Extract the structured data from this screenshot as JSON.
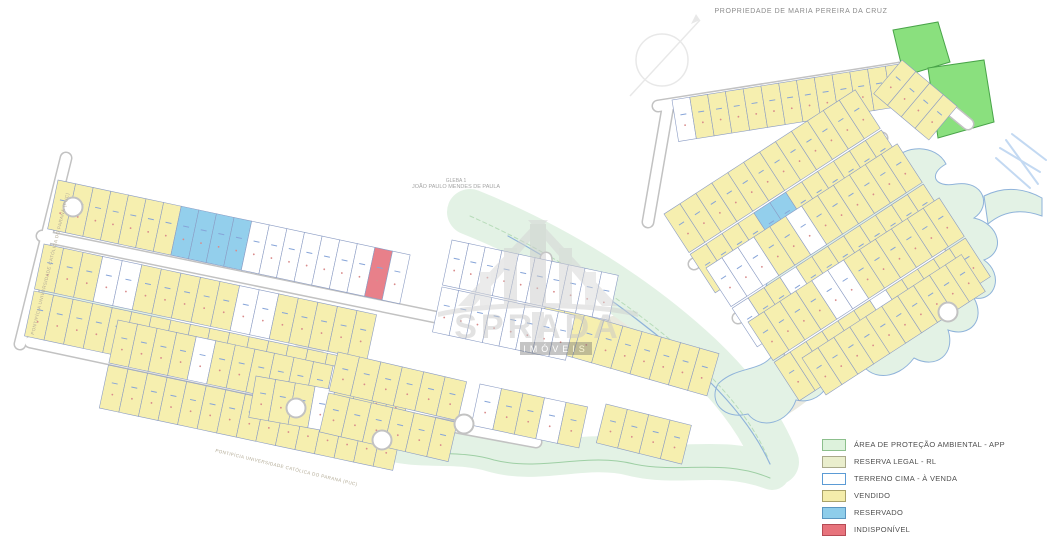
{
  "title": {
    "text": "PROPRIEDADE DE MARIA PEREIRA DA CRUZ"
  },
  "gleba_label": {
    "line1": "GLEBA 1",
    "line2": "JOÃO PAULO MENDES DE PAULA"
  },
  "road_labels": {
    "left": "PONTIFÍCIA UNIVERSIDADE CATÓLICA DO PARANÁ (PUC)",
    "bottom": "PONTIFÍCIA UNIVERSIDADE CATÓLICA DO PARANÁ (PUC)"
  },
  "watermark": {
    "brand": "SPRADA",
    "subtitle": "IMÓVEIS"
  },
  "legend": {
    "items": [
      {
        "label": "ÁREA DE PROTEÇÃO AMBIENTAL - APP",
        "fill": "#ddf2dc",
        "border": "#8cbf8c"
      },
      {
        "label": "RESERVA LEGAL - RL",
        "fill": "#eaeecd",
        "border": "#a9a98a"
      },
      {
        "label": "TERRENO CIMA - À VENDA",
        "fill": "#ffffff",
        "border": "#5b9bd5"
      },
      {
        "label": "VENDIDO",
        "fill": "#f4edab",
        "border": "#a9a26a"
      },
      {
        "label": "RESERVADO",
        "fill": "#8ecdea",
        "border": "#5a96c0"
      },
      {
        "label": "INDISPONÍVEL",
        "fill": "#e7737c",
        "border": "#b54b55"
      }
    ]
  },
  "map": {
    "colors": {
      "vendido": "#f6efaf",
      "a_venda": "#ffffff",
      "reservado": "#93cfec",
      "indisponivel": "#e8808a",
      "lot_border": "#8b9cc4",
      "app": "#8ae07e",
      "app_border": "#49a449",
      "corridor": "#e3f2e5",
      "corridor_border": "#8fb3da",
      "vegetation": "#b8dcba",
      "rl": "#eaeae0",
      "road_casing": "#c2c2c2",
      "road_fill": "#ffffff",
      "mark_blue": "#86a4d8",
      "mark_red": "#d98c8c",
      "cascade": "#c3d9f2",
      "compass": "#e6e6e6"
    },
    "regions": [
      {
        "name": "reserva-legal-area",
        "d": "M838,192 C884,216 908,244 898,286 C888,324 858,354 820,390 C800,408 778,422 762,426 C768,394 764,368 778,338 C760,332 766,302 786,292 C774,278 782,256 802,252 C798,230 816,208 838,192 Z",
        "fill": "#eaeae0"
      },
      {
        "name": "reserva-legal-area",
        "d": "M282,332 L330,308 L354,332 L310,360 Z",
        "fill": "#e9e9df"
      },
      {
        "name": "reserva-legal-area",
        "d": "M598,320 L656,304 L682,332 L636,362 L600,352 Z",
        "fill": "#e9e9df"
      },
      {
        "name": "app-corridor-bottom",
        "d": "M55,298 C130,334 180,330 225,366 C272,402 318,394 356,426 C400,460 448,440 492,454 C540,468 584,446 632,458 C680,470 720,452 772,472",
        "stroke": "#e3f2e5",
        "w": 36
      },
      {
        "name": "app-corridor-central",
        "d": "M470,212 C560,248 640,300 700,356 C740,394 764,430 776,462",
        "stroke": "#e3f2e5",
        "w": 46
      },
      {
        "name": "app-stream-buffer",
        "d": "M836,184 C842,160 870,150 892,162 C904,144 936,144 946,164 C928,174 934,188 956,184 C984,180 992,206 974,218 C1000,224 1006,252 984,260 C1004,274 996,302 974,298 C986,320 970,338 948,330 C956,354 936,370 914,358 C896,382 868,380 860,360 C838,374 814,362 816,340 C794,346 778,328 788,310 C764,308 758,284 776,274 C758,264 762,240 782,236 C770,222 778,202 798,200 C810,186 822,180 836,184 Z",
        "fill": "#e3f2e5",
        "stroke": "#8fb3da",
        "w": 1
      },
      {
        "name": "app-stream-buffer",
        "d": "M828,352 C840,380 820,406 796,400 C788,424 760,430 748,414 C724,420 708,402 718,384 C736,366 760,372 772,356 C788,340 812,336 828,352 Z",
        "fill": "#e3f2e5",
        "stroke": "#8fb3da",
        "w": 1
      },
      {
        "name": "stream-outlet",
        "d": "M984,196 C1004,186 1024,188 1042,198 L1042,216 C1020,208 1002,212 988,224 Z",
        "fill": "#e3f2e5",
        "stroke": "#8fb3da",
        "w": 1
      },
      {
        "name": "vegetation-line",
        "d": "M470,216 C556,254 634,306 696,362 C734,398 756,430 768,458",
        "stroke": "#b8dcba",
        "w": 1,
        "dash": "4,3"
      },
      {
        "name": "stream-line",
        "d": "M508,236 C588,280 654,328 710,382 C742,414 760,442 770,464",
        "stroke": "#8fb3da",
        "w": 1.2
      },
      {
        "name": "stream-line",
        "d": "M60,306 C132,340 184,336 228,372 C274,406 320,400 358,432 C402,464 450,446 494,460 C542,472 586,452 634,464 C682,474 722,458 770,478",
        "stroke": "#9ecfa4",
        "w": 1
      },
      {
        "name": "app-area",
        "d": "M893,30 L938,22 L950,62 L904,76 Z",
        "fill": "#8ae07e",
        "stroke": "#49a449",
        "w": 1
      },
      {
        "name": "app-area",
        "d": "M928,68 L984,60 L994,122 L938,138 Z",
        "fill": "#8ae07e",
        "stroke": "#49a449",
        "w": 1
      }
    ],
    "roads": [
      {
        "x1": 20,
        "y1": 344,
        "x2": 66,
        "y2": 158
      },
      {
        "x1": 42,
        "y1": 236,
        "x2": 440,
        "y2": 318
      },
      {
        "x1": 30,
        "y1": 342,
        "x2": 246,
        "y2": 388
      },
      {
        "x1": 246,
        "y1": 388,
        "x2": 536,
        "y2": 442
      },
      {
        "x1": 440,
        "y1": 318,
        "x2": 634,
        "y2": 336
      },
      {
        "x1": 546,
        "y1": 258,
        "x2": 556,
        "y2": 334
      },
      {
        "x1": 73,
        "y1": 207,
        "x2": 132,
        "y2": 220
      },
      {
        "x1": 648,
        "y1": 222,
        "x2": 668,
        "y2": 106
      },
      {
        "x1": 658,
        "y1": 106,
        "x2": 900,
        "y2": 68
      },
      {
        "x1": 900,
        "y1": 68,
        "x2": 968,
        "y2": 124
      },
      {
        "x1": 694,
        "y1": 264,
        "x2": 882,
        "y2": 138
      },
      {
        "x1": 738,
        "y1": 318,
        "x2": 914,
        "y2": 198
      },
      {
        "x1": 790,
        "y1": 354,
        "x2": 940,
        "y2": 252
      },
      {
        "x1": 616,
        "y1": 334,
        "x2": 700,
        "y2": 366
      },
      {
        "x1": 920,
        "y1": 262,
        "x2": 948,
        "y2": 308
      }
    ],
    "blocks": [
      {
        "name": "band1",
        "x": 58,
        "y": 180,
        "rot": 12,
        "lotW": 18,
        "rows": [
          {
            "d": 50,
            "seq": "VVVVVVVBBBBWWWWWWWRW"
          }
        ]
      },
      {
        "name": "band2",
        "x": 44,
        "y": 244,
        "rot": 12,
        "lotW": 20,
        "rows": [
          {
            "d": 46,
            "seq": "VVVWWVVVVVWWVVVVV"
          },
          {
            "d": 46,
            "seq": "VVVVVVVVVVVVVVVVV"
          }
        ]
      },
      {
        "name": "band3",
        "x": 118,
        "y": 320,
        "rot": 12,
        "lotW": 20,
        "rows": [
          {
            "d": 44,
            "seq": "VVVVWVVVVVVWVVV"
          },
          {
            "d": 44,
            "seq": "VVVVVVVVVVVVVVV"
          }
        ]
      },
      {
        "name": "band4a",
        "x": 256,
        "y": 376,
        "rot": 10,
        "lotW": 20,
        "rows": [
          {
            "d": 42,
            "seq": "VVVWVV"
          }
        ]
      },
      {
        "name": "band4b",
        "x": 338,
        "y": 352,
        "rot": 13,
        "lotW": 22,
        "rows": [
          {
            "d": 40,
            "seq": "VVVVVV"
          },
          {
            "d": 40,
            "seq": "VVVVVV"
          }
        ]
      },
      {
        "name": "band4c",
        "x": 480,
        "y": 384,
        "rot": 12,
        "lotW": 22,
        "rows": [
          {
            "d": 42,
            "seq": "WVVWV"
          }
        ]
      },
      {
        "name": "band4d",
        "x": 546,
        "y": 304,
        "rot": 16,
        "lotW": 20,
        "rows": [
          {
            "d": 44,
            "seq": "VVVVVVVVV"
          }
        ]
      },
      {
        "name": "band4e",
        "x": 606,
        "y": 404,
        "rot": 14,
        "lotW": 22,
        "rows": [
          {
            "d": 40,
            "seq": "VVVV"
          }
        ]
      },
      {
        "name": "middle",
        "x": 452,
        "y": 240,
        "rot": 12,
        "lotW": 17,
        "rows": [
          {
            "d": 46,
            "seq": "WWWWWWWWWW"
          },
          {
            "d": 46,
            "seq": "WWWWWWWW"
          }
        ]
      },
      {
        "name": "rw-top",
        "x": 672,
        "y": 100,
        "rot": -9,
        "lotW": 18,
        "rows": [
          {
            "d": 42,
            "seq": "WVVVVVVVVVVVV"
          }
        ]
      },
      {
        "name": "rw-bend",
        "x": 902,
        "y": 60,
        "rot": 40,
        "lotW": 18,
        "rows": [
          {
            "d": 44,
            "seq": "VVVV"
          }
        ]
      },
      {
        "name": "rw-b1",
        "x": 664,
        "y": 214,
        "rot": -33,
        "lotW": 19,
        "rows": [
          {
            "d": 46,
            "seq": "VVVVVVVVVVVV"
          },
          {
            "d": 46,
            "seq": "VVVVBBVVVVVV"
          }
        ]
      },
      {
        "name": "rw-b2",
        "x": 706,
        "y": 268,
        "rot": -33,
        "lotW": 19,
        "rows": [
          {
            "d": 46,
            "seq": "WWWVVWVVVVVV"
          },
          {
            "d": 46,
            "seq": "WVVWVVVVVVVV"
          }
        ]
      },
      {
        "name": "rw-b3",
        "x": 748,
        "y": 322,
        "rot": -33,
        "lotW": 19,
        "rows": [
          {
            "d": 46,
            "seq": "VVVVWWVVVVVV"
          },
          {
            "d": 46,
            "seq": "VVVVVVWVVVVV"
          }
        ]
      },
      {
        "name": "rw-b4",
        "x": 802,
        "y": 358,
        "rot": -33,
        "lotW": 19,
        "rows": [
          {
            "d": 44,
            "seq": "VVVVVVVVVV"
          }
        ]
      }
    ],
    "culdesacs": [
      {
        "x": 73,
        "y": 207
      },
      {
        "x": 296,
        "y": 408
      },
      {
        "x": 382,
        "y": 440
      },
      {
        "x": 464,
        "y": 424
      },
      {
        "x": 948,
        "y": 312
      }
    ],
    "cascade": [
      {
        "x1": 1000,
        "y1": 148,
        "x2": 1040,
        "y2": 172
      },
      {
        "x1": 1006,
        "y1": 140,
        "x2": 1038,
        "y2": 184
      },
      {
        "x1": 1012,
        "y1": 134,
        "x2": 1046,
        "y2": 160
      },
      {
        "x1": 996,
        "y1": 158,
        "x2": 1030,
        "y2": 188
      }
    ]
  }
}
